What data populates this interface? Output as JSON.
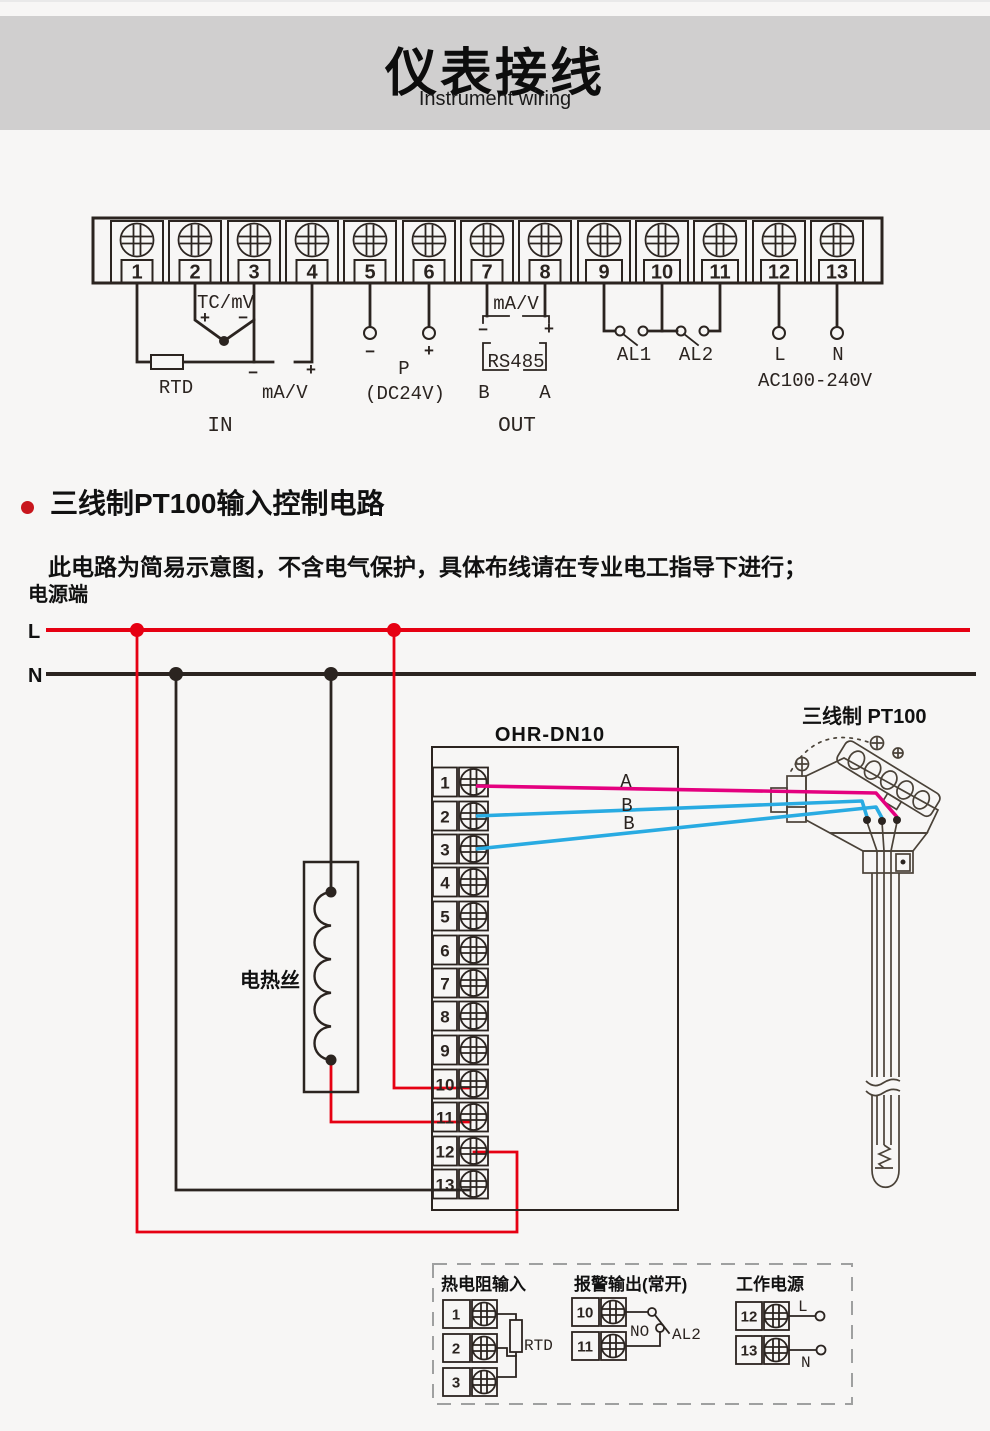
{
  "header": {
    "title": "仪表接线",
    "subtitle": "Instrument wiring"
  },
  "section": {
    "title": "三线制PT100输入控制电路",
    "note": "此电路为简易示意图，不含电气保护，具体布线请在专业电工指导下进行；"
  },
  "terminal_block": {
    "numbers": [
      "1",
      "2",
      "3",
      "4",
      "5",
      "6",
      "7",
      "8",
      "9",
      "10",
      "11",
      "12",
      "13"
    ],
    "tc_mv": "TC/mV",
    "rtd": "RTD",
    "ma_v": "mA/V",
    "in_label": "IN",
    "p": "P",
    "dc24v": "(DC24V)",
    "rs485": "RS485",
    "b": "B",
    "a": "A",
    "out_label": "OUT",
    "al1": "AL1",
    "al2": "AL2",
    "l": "L",
    "n": "N",
    "ac": "AC100-240V",
    "plus": "+",
    "minus": "−"
  },
  "circuit": {
    "power_label": "电源端",
    "l": "L",
    "n": "N",
    "device": "OHR-DN10",
    "numbers": [
      "1",
      "2",
      "3",
      "4",
      "5",
      "6",
      "7",
      "8",
      "9",
      "10",
      "11",
      "12",
      "13"
    ],
    "heater": "电热丝",
    "sensor": "三线制 PT100",
    "wire_a": "A",
    "wire_b1": "B",
    "wire_b2": "B"
  },
  "legend": {
    "rtd_group": {
      "title": "热电阻输入",
      "n1": "1",
      "n2": "2",
      "n3": "3",
      "rtd": "RTD"
    },
    "alarm_group": {
      "title": "报警输出(常开)",
      "n10": "10",
      "n11": "11",
      "no": "NO",
      "al2": "AL2"
    },
    "power_group": {
      "title": "工作电源",
      "n12": "12",
      "n13": "13",
      "l": "L",
      "n": "N"
    }
  },
  "colors": {
    "accent_red": "#e60012",
    "wire_magenta": "#e4007f",
    "wire_cyan": "#29abe2",
    "line_dark": "#2b2420",
    "header_band": "#d0cfcf",
    "page_bg": "#f7f6f5",
    "bullet": "#c8161d",
    "legend_dash": "#9fa0a0"
  }
}
